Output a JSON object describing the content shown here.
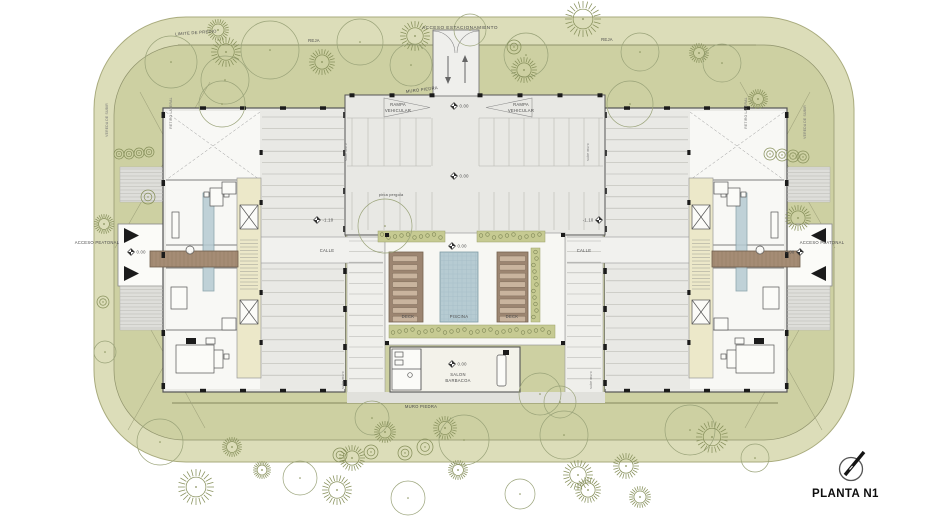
{
  "title": "PLANTA N1",
  "colors": {
    "site_outer": "#dcddb9",
    "site_inner": "#cdd0a2",
    "boundary": "#a9ab7d",
    "fence": "#8f926b",
    "hall": "#e8e8e4",
    "wing": "#eaeae6",
    "unit": "#f8f8f5",
    "park": "#e9e9e5",
    "colstrip": "#efefeb",
    "calle": "#f1f1ee",
    "court": "#f7f7f3",
    "walk": "#e1e1dc",
    "entry": "#efefec",
    "core": "#ece8c9",
    "water": "#b6cbd2",
    "deck": "#9c8571",
    "lounge": "#c9b49e",
    "bridge": "#a58c75",
    "plaza": "#fbfbf8",
    "hatch": "#dededa",
    "green": "#c6ca92",
    "stone": "#7e8656",
    "tree": "#87905b",
    "canopy": "#9aa379",
    "ink": "#4a4a4a",
    "wall": "#555555",
    "black": "#1b1b1b"
  },
  "labels": {
    "acceso_estacionamiento": "ACCESO ESTACIONAMIENTO",
    "limite_predio": "LIMITE DE PREDIO",
    "reja": "REJA",
    "muro_piedra": "MURO PIEDRA",
    "pirca_pergola": "pirca pergola",
    "rampa_l1": "RAMPA",
    "rampa_l2": "VEHICULAR",
    "calle": "CALLE",
    "deck": "DECK",
    "piscina": "PISCINA",
    "salon_l1": "SALON",
    "salon_l2": "BARBACOA",
    "acceso_peatonal": "ACCESO PEATONAL",
    "vereda": "VEREDA DE SUBIR",
    "retiro": "RETIRO LATERAL",
    "sube": "sube muro",
    "planta": "PLANTA N1"
  },
  "levels": [
    {
      "x": 454,
      "y": 106,
      "t": "0.00"
    },
    {
      "x": 454,
      "y": 176,
      "t": "0.00"
    },
    {
      "x": 452,
      "y": 246,
      "t": "0.00"
    },
    {
      "x": 452,
      "y": 364,
      "t": "0.00"
    },
    {
      "x": 131,
      "y": 252,
      "t": "0.00"
    },
    {
      "x": 800,
      "y": 252,
      "t": "0.00",
      "side": "left"
    },
    {
      "x": 317,
      "y": 220,
      "t": "-1.10"
    },
    {
      "x": 599,
      "y": 220,
      "t": "-1.10",
      "side": "left"
    }
  ],
  "trees": [
    [
      171,
      62,
      26,
      "o"
    ],
    [
      225,
      80,
      24,
      "o"
    ],
    [
      226,
      52,
      15,
      "c"
    ],
    [
      270,
      50,
      29,
      "o"
    ],
    [
      218,
      30,
      11,
      "c"
    ],
    [
      322,
      62,
      13,
      "c"
    ],
    [
      360,
      42,
      23,
      "o"
    ],
    [
      415,
      36,
      15,
      "c"
    ],
    [
      411,
      65,
      21,
      "o"
    ],
    [
      470,
      30,
      16,
      "o"
    ],
    [
      514,
      47,
      7,
      "s"
    ],
    [
      526,
      55,
      22,
      "o"
    ],
    [
      524,
      70,
      13,
      "c"
    ],
    [
      583,
      19,
      18,
      "c"
    ],
    [
      640,
      52,
      19,
      "o"
    ],
    [
      699,
      53,
      10,
      "c"
    ],
    [
      722,
      63,
      19,
      "o"
    ],
    [
      758,
      99,
      10,
      "c"
    ],
    [
      119,
      154,
      5,
      "s"
    ],
    [
      129,
      154,
      5,
      "s"
    ],
    [
      139,
      153,
      5,
      "s"
    ],
    [
      149,
      152,
      5,
      "s"
    ],
    [
      148,
      197,
      7,
      "s"
    ],
    [
      104,
      224,
      10,
      "c"
    ],
    [
      103,
      302,
      6,
      "s"
    ],
    [
      105,
      352,
      11,
      "o"
    ],
    [
      222,
      104,
      23,
      "o"
    ],
    [
      630,
      104,
      23,
      "o"
    ],
    [
      385,
      226,
      27,
      "o"
    ],
    [
      540,
      394,
      21,
      "o"
    ],
    [
      770,
      154,
      6,
      "s"
    ],
    [
      782,
      155,
      6,
      "s"
    ],
    [
      793,
      156,
      6,
      "s"
    ],
    [
      803,
      157,
      6,
      "s"
    ],
    [
      798,
      218,
      13,
      "c"
    ],
    [
      160,
      442,
      23,
      "o"
    ],
    [
      196,
      487,
      18,
      "c"
    ],
    [
      232,
      447,
      10,
      "c"
    ],
    [
      262,
      470,
      9,
      "c"
    ],
    [
      300,
      478,
      17,
      "o"
    ],
    [
      337,
      490,
      15,
      "c"
    ],
    [
      372,
      418,
      17,
      "o"
    ],
    [
      385,
      432,
      11,
      "c"
    ],
    [
      352,
      458,
      13,
      "c"
    ],
    [
      405,
      453,
      7,
      "s"
    ],
    [
      425,
      447,
      8,
      "s"
    ],
    [
      371,
      452,
      7,
      "s"
    ],
    [
      340,
      455,
      7,
      "s"
    ],
    [
      445,
      428,
      12,
      "c"
    ],
    [
      464,
      440,
      25,
      "o"
    ],
    [
      458,
      470,
      10,
      "c"
    ],
    [
      560,
      402,
      16,
      "o"
    ],
    [
      564,
      435,
      24,
      "o"
    ],
    [
      578,
      475,
      15,
      "c"
    ],
    [
      626,
      466,
      13,
      "c"
    ],
    [
      690,
      430,
      25,
      "o"
    ],
    [
      712,
      437,
      16,
      "c"
    ],
    [
      755,
      458,
      14,
      "o"
    ],
    [
      408,
      498,
      17,
      "o"
    ],
    [
      588,
      490,
      13,
      "c"
    ],
    [
      520,
      494,
      15,
      "o"
    ],
    [
      640,
      497,
      11,
      "c"
    ]
  ]
}
